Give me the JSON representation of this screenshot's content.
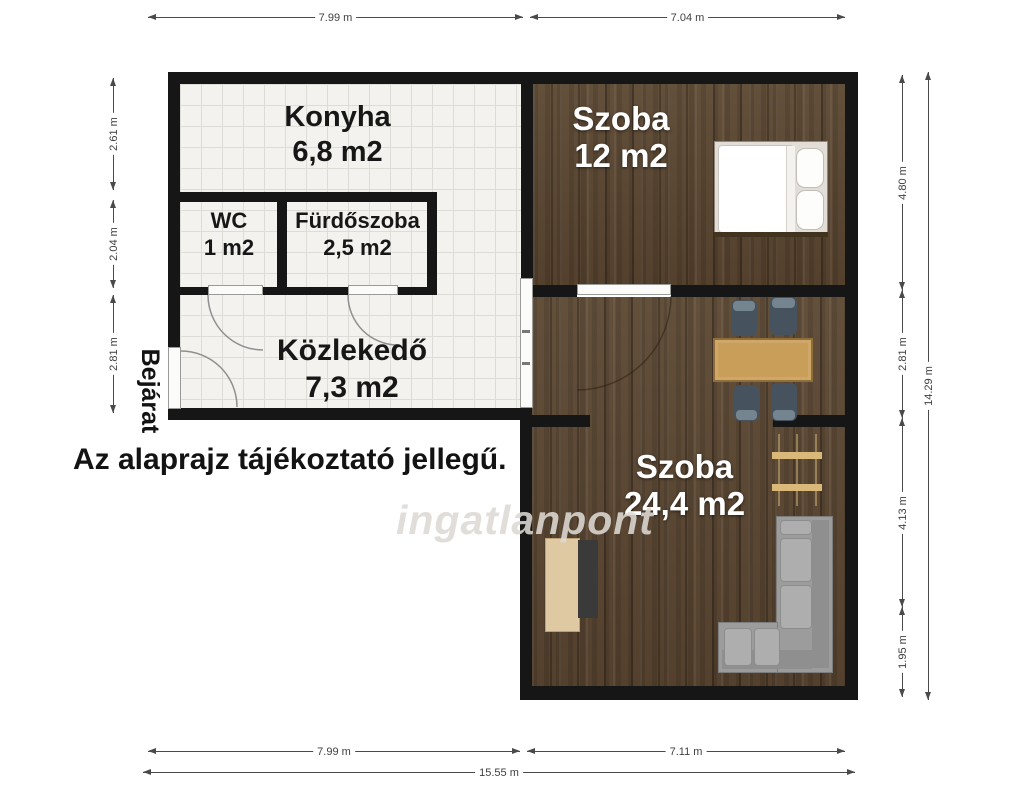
{
  "plan": {
    "rooms": {
      "konyha": {
        "name": "Konyha",
        "area": "6,8 m2"
      },
      "wc": {
        "name": "WC",
        "area": "1 m2"
      },
      "furdoszoba": {
        "name": "Fürdőszoba",
        "area": "2,5 m2"
      },
      "kozlekedo": {
        "name": "Közlekedő",
        "area": "7,3 m2"
      },
      "szoba12": {
        "name": "Szoba",
        "area": "12 m2"
      },
      "szoba24": {
        "name": "Szoba",
        "area": "24,4 m2"
      }
    },
    "entrance_label": "Bejárat",
    "disclaimer": "Az alaprajz tájékoztató jellegű.",
    "watermark": "ingatlanpont",
    "dimensions": {
      "top": [
        {
          "label": "7.99 m"
        },
        {
          "label": "7.04 m"
        }
      ],
      "bottom": [
        {
          "label": "7.99 m"
        },
        {
          "label": "7.11 m"
        },
        {
          "label": "15.55 m"
        }
      ],
      "left": [
        {
          "label": "2.61 m"
        },
        {
          "label": "2.04 m"
        },
        {
          "label": "2.81 m"
        }
      ],
      "right": [
        {
          "label": "4.80 m"
        },
        {
          "label": "2.81 m"
        },
        {
          "label": "4.13 m"
        },
        {
          "label": "1.95 m"
        },
        {
          "label": "14.29 m"
        }
      ]
    },
    "furniture": [
      "double-bed",
      "dining-table",
      "dining-chairs",
      "wall-shelf",
      "tv-stand-with-tv",
      "corner-sofa"
    ],
    "colors": {
      "wall": "#161616",
      "tile_floor": "#f3f2ee",
      "tile_line": "#dedcd6",
      "wood_floor": "#5b4734",
      "dim_text": "#3f3f3f",
      "table": "#c99e58",
      "chair": "#46525e",
      "sofa": "#9c9c9c"
    }
  }
}
